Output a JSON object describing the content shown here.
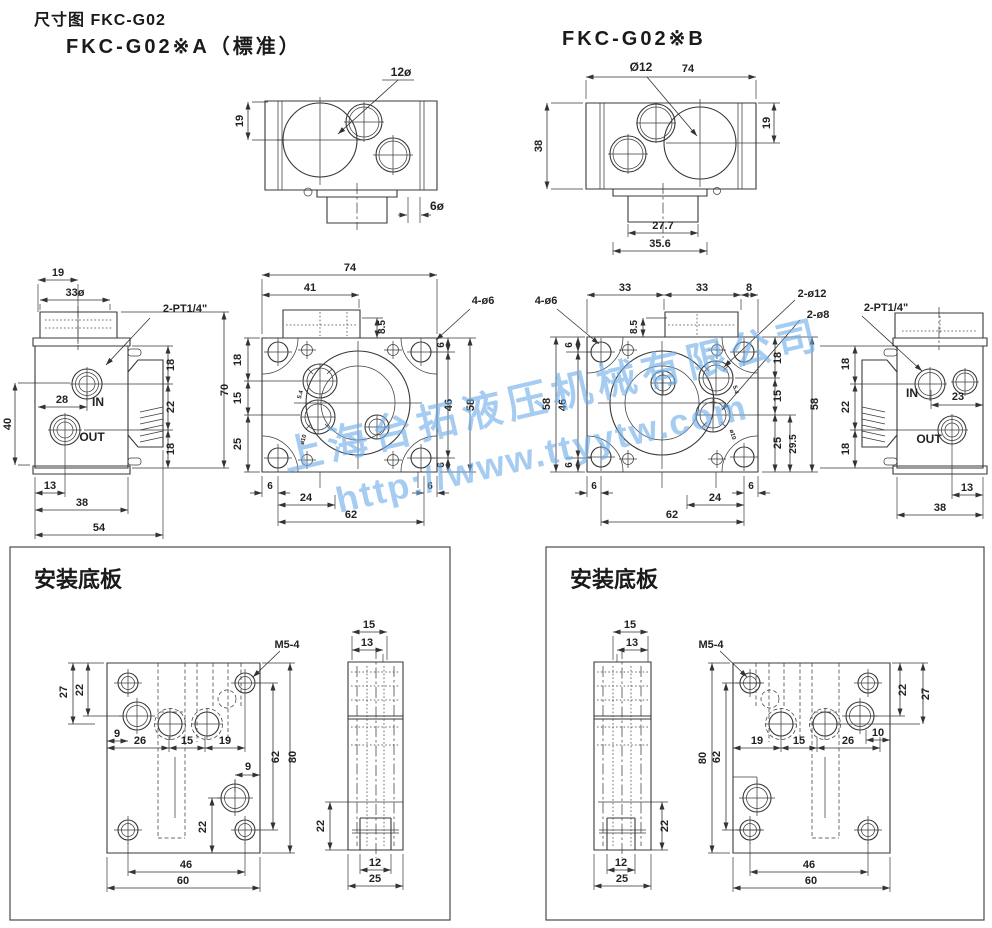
{
  "header": {
    "doc_title": "尺寸图 FKC-G02",
    "variant_a": "FKC-G02※A（標准）",
    "variant_b": "FKC-G02※B"
  },
  "panels": {
    "mounting_plate_title": "安装底板"
  },
  "watermark": {
    "line1": "上海台拓液压机械有限公司",
    "line2": "http://www.ttyytw.com",
    "color": "#70aee9"
  },
  "colors": {
    "line": "#383838",
    "text": "#222222",
    "background": "#ffffff"
  },
  "dim_labels": [
    {
      "t": "12ø",
      "x": 401,
      "y": 76,
      "fs": 12
    },
    {
      "t": "19",
      "x": 243,
      "y": 121,
      "r": -90
    },
    {
      "t": "6ø",
      "x": 437,
      "y": 210,
      "fs": 12
    },
    {
      "t": "Ø12",
      "x": 641,
      "y": 71,
      "fs": 12
    },
    {
      "t": "74",
      "x": 688,
      "y": 72
    },
    {
      "t": "38",
      "x": 542,
      "y": 146,
      "r": -90
    },
    {
      "t": "19",
      "x": 770,
      "y": 123,
      "r": -90
    },
    {
      "t": "27.7",
      "x": 663,
      "y": 229
    },
    {
      "t": "35.6",
      "x": 660,
      "y": 247
    },
    {
      "t": "19",
      "x": 58,
      "y": 276
    },
    {
      "t": "33ø",
      "x": 75,
      "y": 296
    },
    {
      "t": "2-PT1/4\"",
      "x": 185,
      "y": 312
    },
    {
      "t": "28",
      "x": 62,
      "y": 403
    },
    {
      "t": "IN",
      "x": 98,
      "y": 406,
      "fs": 12
    },
    {
      "t": "OUT",
      "x": 92,
      "y": 441,
      "fs": 12
    },
    {
      "t": "40",
      "x": 11,
      "y": 424,
      "r": -90
    },
    {
      "t": "13",
      "x": 50,
      "y": 489
    },
    {
      "t": "38",
      "x": 82,
      "y": 506
    },
    {
      "t": "54",
      "x": 99,
      "y": 531
    },
    {
      "t": "18",
      "x": 174,
      "y": 365,
      "r": -90
    },
    {
      "t": "22",
      "x": 174,
      "y": 407,
      "r": -90
    },
    {
      "t": "18",
      "x": 174,
      "y": 449,
      "r": -90
    },
    {
      "t": "70",
      "x": 228,
      "y": 390,
      "r": -90
    },
    {
      "t": "74",
      "x": 350,
      "y": 271
    },
    {
      "t": "41",
      "x": 310,
      "y": 291
    },
    {
      "t": "8.5",
      "x": 385,
      "y": 327,
      "r": -90,
      "fs": 10
    },
    {
      "t": "4-ø6",
      "x": 483,
      "y": 304
    },
    {
      "t": "4-ø6",
      "x": 546,
      "y": 304
    },
    {
      "t": "18",
      "x": 241,
      "y": 360,
      "r": -90
    },
    {
      "t": "15",
      "x": 241,
      "y": 398,
      "r": -90
    },
    {
      "t": "25",
      "x": 241,
      "y": 444,
      "r": -90
    },
    {
      "t": "6",
      "x": 444,
      "y": 345,
      "r": -90,
      "fs": 10
    },
    {
      "t": "46",
      "x": 452,
      "y": 405,
      "r": -90
    },
    {
      "t": "6",
      "x": 444,
      "y": 465,
      "r": -90,
      "fs": 10
    },
    {
      "t": "58",
      "x": 474,
      "y": 405,
      "r": -90
    },
    {
      "t": "6",
      "x": 270,
      "y": 489,
      "fs": 10
    },
    {
      "t": "24",
      "x": 306,
      "y": 501
    },
    {
      "t": "62",
      "x": 351,
      "y": 518
    },
    {
      "t": "6",
      "x": 430,
      "y": 489,
      "fs": 10
    },
    {
      "t": "5.4",
      "x": 302,
      "y": 395,
      "r": -75,
      "fs": 6
    },
    {
      "t": "ø10",
      "x": 305,
      "y": 440,
      "r": -75,
      "fs": 6
    },
    {
      "t": "33",
      "x": 625,
      "y": 291
    },
    {
      "t": "33",
      "x": 702,
      "y": 291
    },
    {
      "t": "8",
      "x": 749,
      "y": 291
    },
    {
      "t": "8.5",
      "x": 637,
      "y": 327,
      "r": -90,
      "fs": 10
    },
    {
      "t": "2-ø12",
      "x": 812,
      "y": 297
    },
    {
      "t": "2-ø8",
      "x": 818,
      "y": 318
    },
    {
      "t": "6",
      "x": 572,
      "y": 345,
      "r": -90,
      "fs": 10
    },
    {
      "t": "46",
      "x": 566,
      "y": 405,
      "r": -90
    },
    {
      "t": "6",
      "x": 572,
      "y": 465,
      "r": -90,
      "fs": 10
    },
    {
      "t": "58",
      "x": 550,
      "y": 404,
      "r": -90
    },
    {
      "t": "18",
      "x": 781,
      "y": 358,
      "r": -90
    },
    {
      "t": "15",
      "x": 781,
      "y": 396,
      "r": -90
    },
    {
      "t": "25",
      "x": 781,
      "y": 443,
      "r": -90
    },
    {
      "t": "29.5",
      "x": 796,
      "y": 444,
      "r": -90,
      "fs": 10
    },
    {
      "t": "58",
      "x": 818,
      "y": 404,
      "r": -90
    },
    {
      "t": "6",
      "x": 594,
      "y": 489,
      "fs": 10
    },
    {
      "t": "24",
      "x": 715,
      "y": 501
    },
    {
      "t": "6",
      "x": 751,
      "y": 489,
      "fs": 10
    },
    {
      "t": "62",
      "x": 672,
      "y": 518
    },
    {
      "t": "5.4",
      "x": 734,
      "y": 390,
      "r": 75,
      "fs": 6
    },
    {
      "t": "ø10",
      "x": 731,
      "y": 435,
      "r": 75,
      "fs": 6
    },
    {
      "t": "2-PT1/4\"",
      "x": 886,
      "y": 311
    },
    {
      "t": "18",
      "x": 849,
      "y": 364,
      "r": -90
    },
    {
      "t": "22",
      "x": 849,
      "y": 407,
      "r": -90
    },
    {
      "t": "18",
      "x": 849,
      "y": 449,
      "r": -90
    },
    {
      "t": "IN",
      "x": 912,
      "y": 397,
      "fs": 12
    },
    {
      "t": "23",
      "x": 958,
      "y": 400
    },
    {
      "t": "OUT",
      "x": 929,
      "y": 443,
      "fs": 12
    },
    {
      "t": "13",
      "x": 967,
      "y": 491
    },
    {
      "t": "38",
      "x": 940,
      "y": 511
    },
    {
      "t": "M5-4",
      "x": 287,
      "y": 648
    },
    {
      "t": "27",
      "x": 67,
      "y": 692,
      "r": -90
    },
    {
      "t": "22",
      "x": 83,
      "y": 690,
      "r": -90
    },
    {
      "t": "9",
      "x": 117,
      "y": 737
    },
    {
      "t": "26",
      "x": 140,
      "y": 744
    },
    {
      "t": "15",
      "x": 187,
      "y": 744
    },
    {
      "t": "19",
      "x": 225,
      "y": 744
    },
    {
      "t": "62",
      "x": 279,
      "y": 757,
      "r": -90
    },
    {
      "t": "80",
      "x": 296,
      "y": 757,
      "r": -90
    },
    {
      "t": "9",
      "x": 248,
      "y": 770
    },
    {
      "t": "22",
      "x": 206,
      "y": 827,
      "r": -90
    },
    {
      "t": "46",
      "x": 186,
      "y": 868
    },
    {
      "t": "60",
      "x": 183,
      "y": 884
    },
    {
      "t": "15",
      "x": 369,
      "y": 628
    },
    {
      "t": "13",
      "x": 367,
      "y": 646
    },
    {
      "t": "22",
      "x": 324,
      "y": 826,
      "r": -90
    },
    {
      "t": "12",
      "x": 375,
      "y": 866
    },
    {
      "t": "25",
      "x": 375,
      "y": 882
    },
    {
      "t": "15",
      "x": 630,
      "y": 628
    },
    {
      "t": "13",
      "x": 632,
      "y": 646
    },
    {
      "t": "22",
      "x": 668,
      "y": 826,
      "r": -90
    },
    {
      "t": "12",
      "x": 621,
      "y": 866
    },
    {
      "t": "25",
      "x": 622,
      "y": 882
    },
    {
      "t": "M5-4",
      "x": 711,
      "y": 648
    },
    {
      "t": "22",
      "x": 906,
      "y": 690,
      "r": -90
    },
    {
      "t": "27",
      "x": 929,
      "y": 694,
      "r": -90
    },
    {
      "t": "10",
      "x": 878,
      "y": 736
    },
    {
      "t": "19",
      "x": 757,
      "y": 744
    },
    {
      "t": "15",
      "x": 799,
      "y": 744
    },
    {
      "t": "26",
      "x": 848,
      "y": 744
    },
    {
      "t": "80",
      "x": 706,
      "y": 758,
      "r": -90
    },
    {
      "t": "62",
      "x": 720,
      "y": 757,
      "r": -90
    },
    {
      "t": "46",
      "x": 809,
      "y": 868
    },
    {
      "t": "60",
      "x": 811,
      "y": 884
    }
  ]
}
